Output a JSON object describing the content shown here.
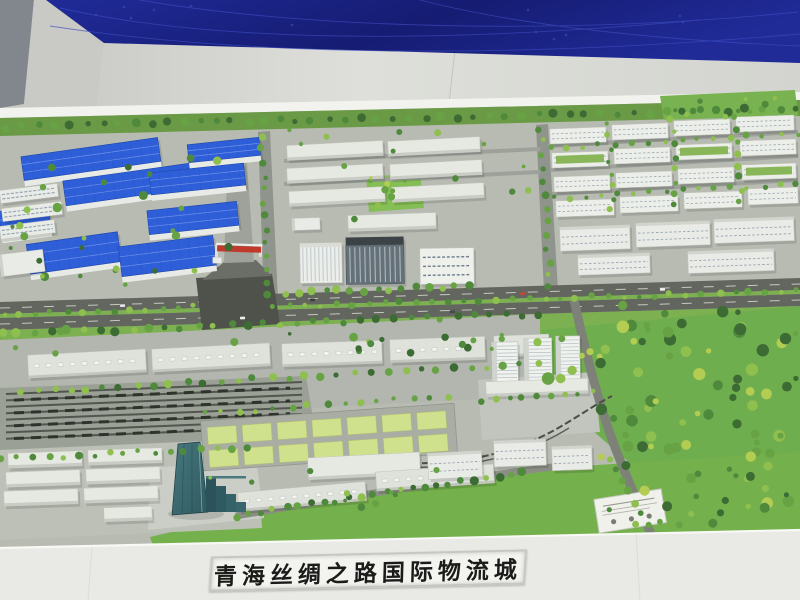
{
  "scene": {
    "kind": "photograph-of-architectural-scale-model",
    "model": {
      "title_plate_text": "青海丝绸之路国际物流城"
    }
  },
  "colors": {
    "backdrop_screen_blue_dark": "#151c72",
    "backdrop_screen_blue": "#202b98",
    "screen_line_blue": "#3e4cc0",
    "wall_gray": "#d2d3ce",
    "wall_side_gray": "#82878e",
    "ledge_white": "#f2f2ee",
    "pavement": "#b7bbb2",
    "road_dark": "#62665e",
    "intersection_dark": "#4e524b",
    "lawn_green": "#7cb050",
    "park_green": "#6fae4e",
    "plot_green": "#cfe18c",
    "warehouse_roof_blue": "#2f5fd8",
    "building_white": "#eceee9",
    "landmark_tower_teal": "#2f5a60",
    "rail_bed_gray": "#9aa095",
    "rail_track_dark": "#51564e",
    "gate_banner_red": "#c03a2c",
    "plinth_white": "#e9eae6",
    "title_text_black": "#1b1b19",
    "tree_palette": [
      "#3c6b33",
      "#4f8a3c",
      "#67a344",
      "#8fbf4e",
      "#b3cc52"
    ]
  }
}
